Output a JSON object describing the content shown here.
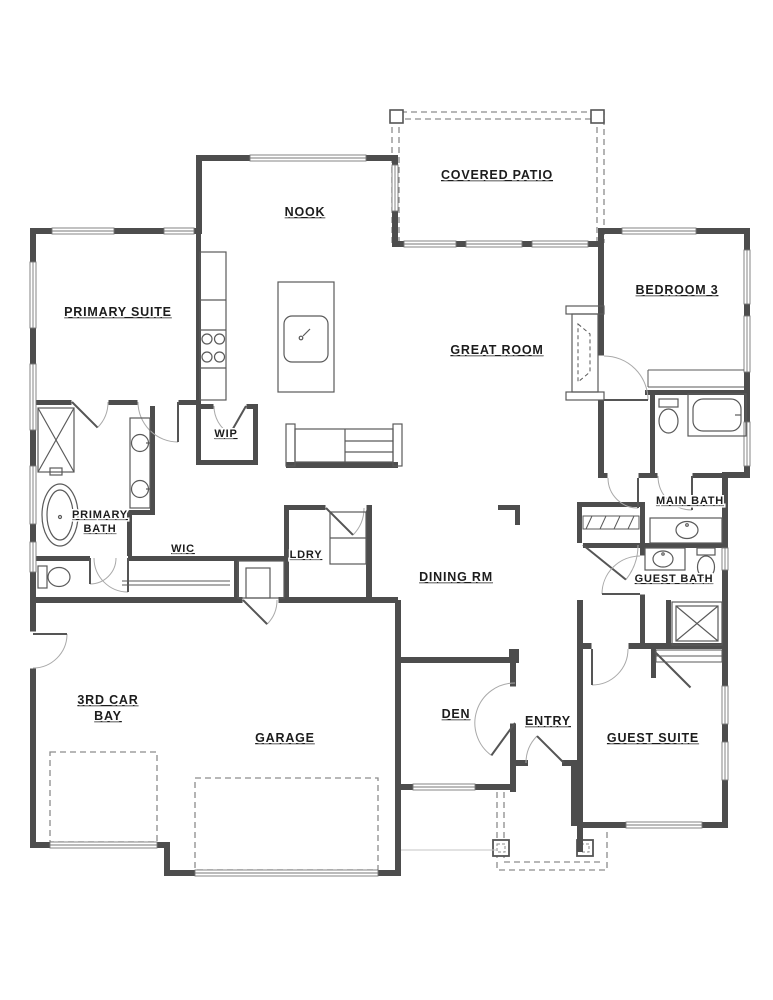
{
  "plan": {
    "type": "single-story residential floor plan",
    "rooms": {
      "covered_patio": {
        "label": "COVERED PATIO"
      },
      "nook": {
        "label": "NOOK"
      },
      "primary_suite": {
        "label": "PRIMARY SUITE"
      },
      "bedroom_3": {
        "label": "BEDROOM 3"
      },
      "great_room": {
        "label": "GREAT ROOM"
      },
      "wip": {
        "label": "WIP"
      },
      "primary_bath": {
        "label": "PRIMARY BATH",
        "lines": [
          "PRIMARY",
          "BATH"
        ]
      },
      "wic": {
        "label": "WIC"
      },
      "ldry": {
        "label": "LDRY"
      },
      "dining_rm": {
        "label": "DINING RM"
      },
      "main_bath": {
        "label": "MAIN BATH"
      },
      "guest_bath": {
        "label": "GUEST BATH"
      },
      "third_car_bay": {
        "label": "3RD CAR BAY",
        "lines": [
          "3RD CAR",
          "BAY"
        ]
      },
      "garage": {
        "label": "GARAGE"
      },
      "den": {
        "label": "DEN"
      },
      "entry": {
        "label": "ENTRY"
      },
      "guest_suite": {
        "label": "GUEST SUITE"
      }
    },
    "fixtures": [
      {
        "name": "cooktop",
        "room": "kitchen"
      },
      {
        "name": "kitchen-island-sink",
        "room": "kitchen"
      },
      {
        "name": "fireplace",
        "room": "great_room"
      },
      {
        "name": "built-in-cabinet",
        "room": "great_room"
      },
      {
        "name": "shower",
        "room": "primary_bath"
      },
      {
        "name": "freestanding-tub",
        "room": "primary_bath"
      },
      {
        "name": "double-vanity-sinks",
        "room": "primary_bath"
      },
      {
        "name": "toilet",
        "room": "primary_bath"
      },
      {
        "name": "closet-shelves",
        "room": "wic"
      },
      {
        "name": "laundry-counter",
        "room": "ldry"
      },
      {
        "name": "toilet",
        "room": "main_bath"
      },
      {
        "name": "bathtub",
        "room": "main_bath"
      },
      {
        "name": "vanity-sink",
        "room": "main_bath"
      },
      {
        "name": "closet-rod",
        "room": "bedroom_3"
      },
      {
        "name": "vanity-sink",
        "room": "guest_bath"
      },
      {
        "name": "toilet",
        "room": "guest_bath"
      },
      {
        "name": "shower",
        "room": "guest_bath"
      },
      {
        "name": "closet-shelf",
        "room": "guest_suite"
      },
      {
        "name": "garage-door-panels",
        "room": "garage"
      },
      {
        "name": "porch-columns",
        "room": "entry"
      },
      {
        "name": "patio-posts",
        "room": "covered_patio"
      }
    ],
    "colors": {
      "background": "#ffffff",
      "walls": "#4d4d4d",
      "fixtures": "#5a5a5a",
      "windows": "#777777",
      "dashed": "#8c8c8c",
      "text": "#1c1c1c"
    }
  }
}
